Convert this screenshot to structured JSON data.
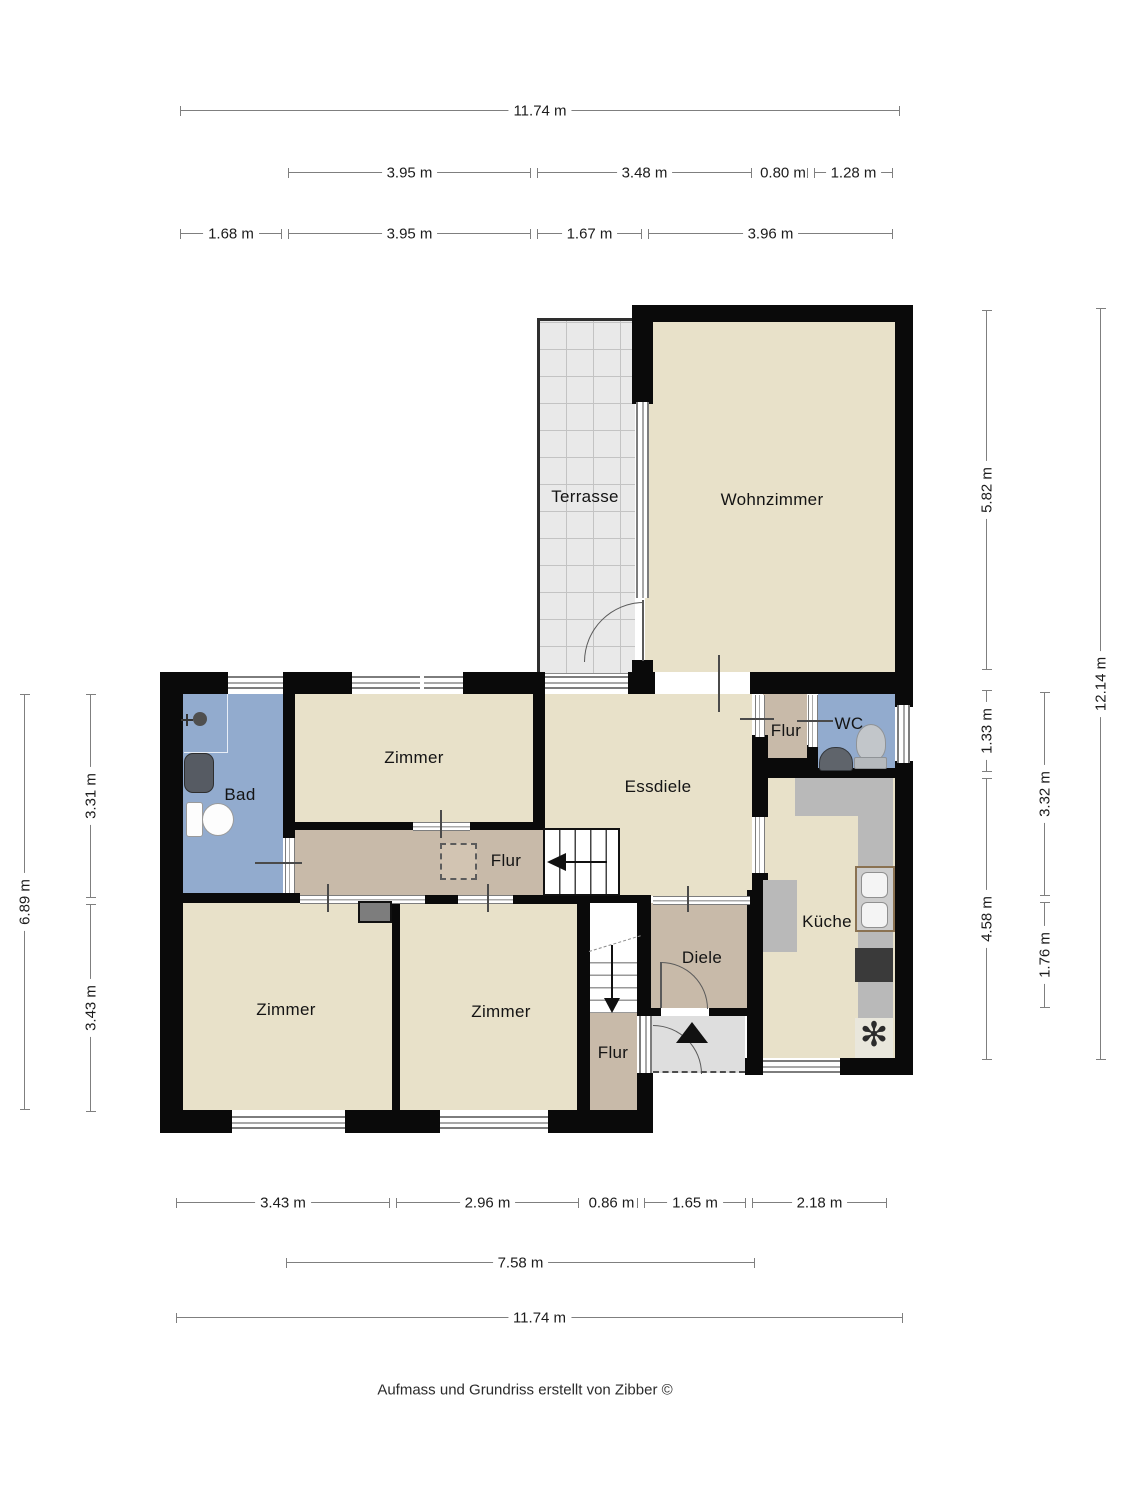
{
  "footer": "Aufmass und Grundriss erstellt von Zibber ©",
  "rooms": {
    "terrasse": {
      "label": "Terrasse"
    },
    "wohnzimmer": {
      "label": "Wohnzimmer"
    },
    "zimmer_top": {
      "label": "Zimmer"
    },
    "bad": {
      "label": "Bad"
    },
    "essdiele": {
      "label": "Essdiele"
    },
    "flur_top": {
      "label": "Flur"
    },
    "wc": {
      "label": "WC"
    },
    "kueche": {
      "label": "Küche"
    },
    "flur_mid": {
      "label": "Flur"
    },
    "diele": {
      "label": "Diele"
    },
    "zimmer_bl": {
      "label": "Zimmer"
    },
    "zimmer_bm": {
      "label": "Zimmer"
    },
    "flur_bottom": {
      "label": "Flur"
    }
  },
  "dims": {
    "top_total": "11.74 m",
    "top_row2": [
      "3.95 m",
      "3.48 m",
      "0.80 m",
      "1.28 m"
    ],
    "top_row3": [
      "1.68 m",
      "3.95 m",
      "1.67 m",
      "3.96 m"
    ],
    "bottom_row1": [
      "3.43 m",
      "2.96 m",
      "0.86 m",
      "1.65 m",
      "2.18 m"
    ],
    "bottom_row2": "7.58 m",
    "bottom_total": "11.74 m",
    "left_outer": "6.89 m",
    "left_inner": [
      "3.31 m",
      "3.43 m"
    ],
    "right_inner": [
      "5.82 m",
      "1.33 m",
      "4.58 m"
    ],
    "right_mid": [
      "3.32 m",
      "1.76 m"
    ],
    "right_outer": "12.14 m"
  },
  "symbols": {
    "stove_fan": "✻"
  },
  "colors": {
    "room_beige": "#e8e1c9",
    "hallway_taupe": "#c8baa9",
    "wet_room_blue": "#92abce",
    "terrace_gray": "#e9e9e9",
    "vestibule_gray": "#dedede",
    "wall_black": "#0a0a0a",
    "counter_gray": "#b9b9b9",
    "stove_dark": "#3a3a3a",
    "sink_frame_brown": "#8a7252"
  }
}
